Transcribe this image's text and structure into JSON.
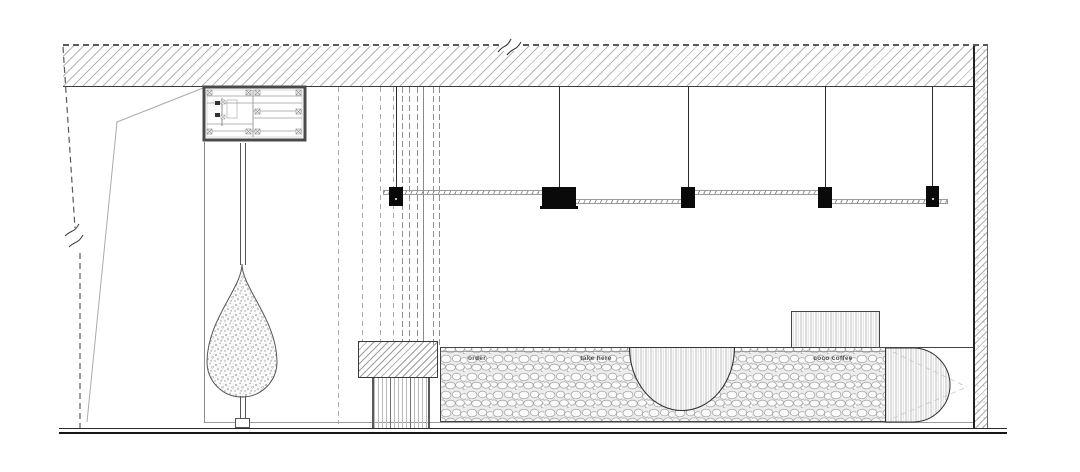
{
  "drawing": {
    "kind": "cafe interior elevation - line drawing",
    "counter_labels": [
      {
        "id": "order",
        "text": "order"
      },
      {
        "id": "take-here",
        "text": "take here"
      },
      {
        "id": "coco-coffee",
        "text": "coco coffee"
      }
    ],
    "colors": {
      "background": "#ffffff",
      "line": "#3c3c3c",
      "hatch": "#b6b6b6",
      "fixture_black": "#0a0a0a",
      "label_text": "#4c4c4c"
    }
  }
}
